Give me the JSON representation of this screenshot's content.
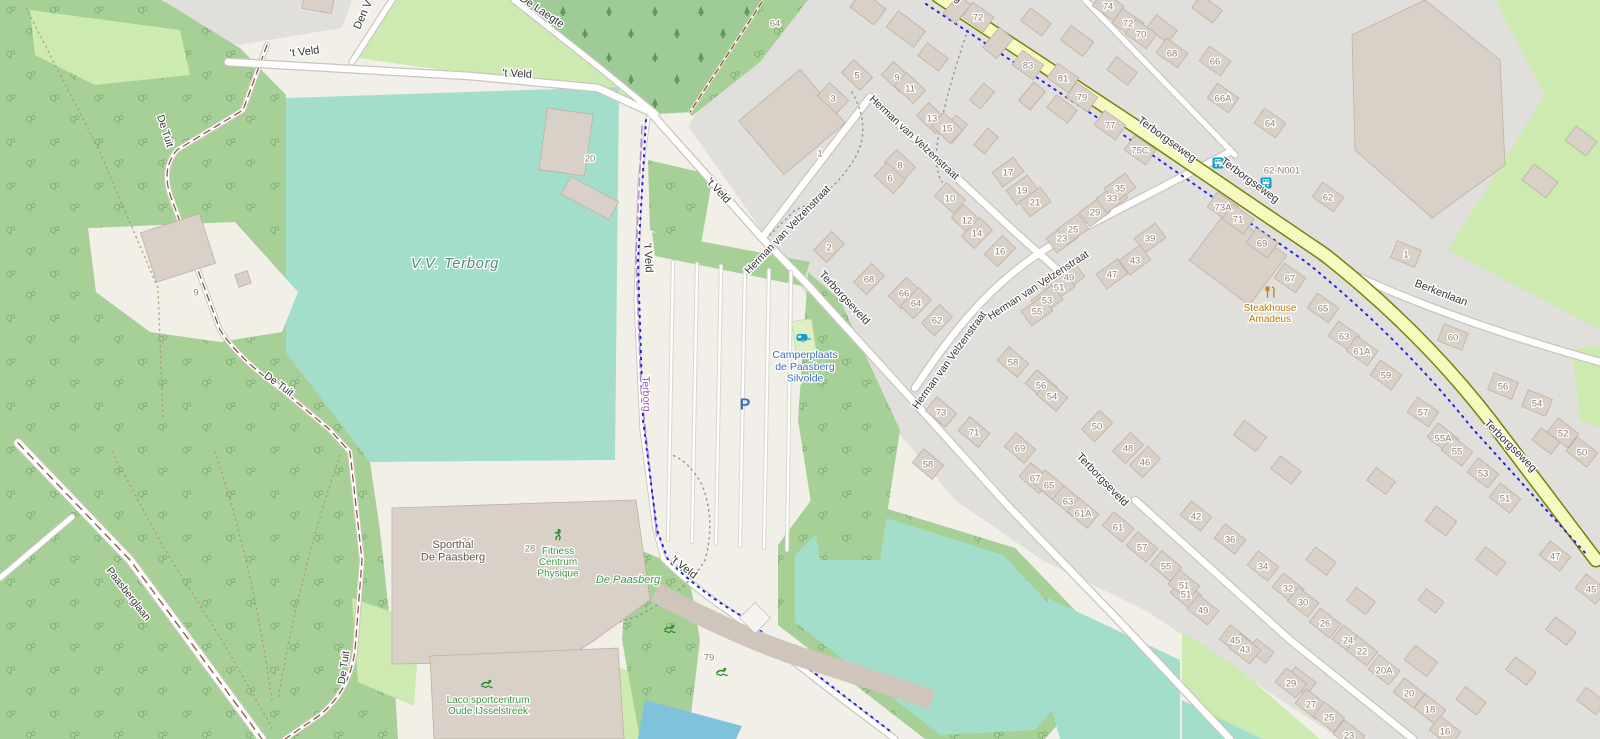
{
  "map": {
    "colors": {
      "background": "#f2efe9",
      "residential": "#e1dfdc",
      "forest": "#a6d096",
      "conifer_forest": "#9fcb97",
      "meadow": "#cdebb0",
      "pitch": "#a3deca",
      "building": "#d9d0c8",
      "building_stroke": "#bfb1a3",
      "road_fill": "#ffffff",
      "road_casing": "#c9c5bf",
      "secondary_road": "#f7fabf",
      "secondary_casing": "#77800a",
      "water": "#7fc3da",
      "cycle_route": "#2222e0",
      "boundary": "#a86fc5",
      "track_dash": "#8a5a3a",
      "street_label": "#353535",
      "house_number": "#8d8072",
      "leisure_label": "#3e9446",
      "tourism_label": "#3f6eb5",
      "amenity_label": "#bd7a00",
      "pitch_label": "#54897b",
      "poi_teal": "#0f9ec7",
      "parking_blue": "#3c6eb4",
      "sport_green": "#2e8b2e"
    },
    "street_labels": [
      {
        "t": "'t Veld",
        "x": 305,
        "y": 55,
        "r": -7,
        "s": 11
      },
      {
        "t": "'t Veld",
        "x": 517,
        "y": 77,
        "r": 3,
        "s": 11
      },
      {
        "t": "De Laegte",
        "x": 540,
        "y": 14,
        "r": 34,
        "s": 11
      },
      {
        "t": "Den V",
        "x": 366,
        "y": 16,
        "r": -66,
        "s": 11
      },
      {
        "t": "'t Veld",
        "x": 716,
        "y": 193,
        "r": 47,
        "s": 11
      },
      {
        "t": "'t Veld",
        "x": 645,
        "y": 258,
        "r": 87,
        "s": 11
      },
      {
        "t": "'t Veld",
        "x": 682,
        "y": 570,
        "r": 38,
        "s": 11
      },
      {
        "t": "De Tuit",
        "x": 162,
        "y": 132,
        "r": 72,
        "s": 10.5
      },
      {
        "t": "De Tuit",
        "x": 277,
        "y": 387,
        "r": 36,
        "s": 10.5
      },
      {
        "t": "De Tuit",
        "x": 347,
        "y": 668,
        "r": -82,
        "s": 10.5
      },
      {
        "t": "Paasberglaan",
        "x": 126,
        "y": 596,
        "r": 52,
        "s": 10.5
      },
      {
        "t": "Terborgseveld",
        "x": 842,
        "y": 300,
        "r": 47,
        "s": 11
      },
      {
        "t": "Terborgseveld",
        "x": 1100,
        "y": 482,
        "r": 46,
        "s": 11
      },
      {
        "t": "Herman van Velzenstraat",
        "x": 790,
        "y": 232,
        "r": -46,
        "s": 10.5
      },
      {
        "t": "Herman van Velzenstraat",
        "x": 912,
        "y": 140,
        "r": 43,
        "s": 10.5
      },
      {
        "t": "Herman van Velzenstraat",
        "x": 1040,
        "y": 288,
        "r": -33,
        "s": 10.5
      },
      {
        "t": "Herman van Velzenstraat",
        "x": 952,
        "y": 362,
        "r": -54,
        "s": 10.5
      },
      {
        "t": "Terborgseweg",
        "x": 930,
        "y": -16,
        "r": 33,
        "s": 11
      },
      {
        "t": "Terborgseweg",
        "x": 1165,
        "y": 142,
        "r": 36,
        "s": 11
      },
      {
        "t": "Terborgseweg",
        "x": 1248,
        "y": 183,
        "r": 36,
        "s": 11
      },
      {
        "t": "Terborgseweg",
        "x": 1508,
        "y": 448,
        "r": 45,
        "s": 11
      },
      {
        "t": "Berkenlaan",
        "x": 1440,
        "y": 296,
        "r": 21,
        "s": 11
      }
    ],
    "place_labels": [
      {
        "lines": [
          "V.V. Terborg"
        ],
        "x": 455,
        "y": 268,
        "c": "#54897b",
        "s": 14.5,
        "i": 1,
        "ls": 0.8
      },
      {
        "lines": [
          "De Paasberg"
        ],
        "x": 628,
        "y": 583,
        "c": "#3e9446",
        "s": 11,
        "i": 1
      },
      {
        "lines": [
          "Terborg"
        ],
        "x": 643,
        "y": 394,
        "c": "#9a56b0",
        "s": 10.5,
        "r": 88
      },
      {
        "lines": [
          "Camperplaats",
          "de Paasberg",
          "Silvolde"
        ],
        "x": 805,
        "y": 358,
        "c": "#3f6eb5",
        "s": 10.5
      },
      {
        "lines": [
          "Steakhouse",
          "Amadeus"
        ],
        "x": 1270,
        "y": 311,
        "c": "#bd7a00",
        "s": 10
      },
      {
        "lines": [
          "Sporthal",
          "De Paasberg"
        ],
        "x": 453,
        "y": 548,
        "c": "#5f564c",
        "s": 11
      },
      {
        "lines": [
          "Fitness",
          "Centrum",
          "Physique"
        ],
        "x": 558,
        "y": 554,
        "c": "#3e9446",
        "s": 10
      },
      {
        "lines": [
          "Laco sportcentrum",
          "Oude IJsselstreek"
        ],
        "x": 488,
        "y": 703,
        "c": "#3e9446",
        "s": 10
      }
    ],
    "house_numbers": [
      [
        "64",
        775,
        23,
        "x"
      ],
      [
        "74",
        1108,
        6,
        35
      ],
      [
        "72",
        978,
        17,
        35
      ],
      [
        "72",
        1128,
        23,
        35
      ],
      [
        "70",
        1141,
        34,
        35
      ],
      [
        "68",
        1172,
        53,
        35
      ],
      [
        "66",
        1215,
        61,
        35
      ],
      [
        "66A",
        1223,
        98,
        35
      ],
      [
        "64",
        1270,
        123,
        35
      ],
      [
        "62-N001",
        1282,
        170,
        "x"
      ],
      [
        "62",
        1328,
        197,
        35
      ],
      [
        "73A",
        1223,
        207,
        35
      ],
      [
        "71",
        1238,
        219,
        35
      ],
      [
        "83",
        1028,
        65,
        35
      ],
      [
        "81",
        1063,
        78,
        35
      ],
      [
        "79",
        1082,
        97,
        35
      ],
      [
        "77",
        1110,
        125,
        35
      ],
      [
        "75C",
        1140,
        150,
        35
      ],
      [
        "5",
        857,
        75,
        43
      ],
      [
        "3",
        833,
        98,
        43
      ],
      [
        "9",
        897,
        77,
        43
      ],
      [
        "11",
        910,
        88,
        43
      ],
      [
        "13",
        932,
        118,
        43
      ],
      [
        "15",
        947,
        128,
        43
      ],
      [
        "1",
        820,
        153,
        "x"
      ],
      [
        "8",
        900,
        165,
        43
      ],
      [
        "6",
        890,
        178,
        43
      ],
      [
        "10",
        950,
        198,
        43
      ],
      [
        "12",
        967,
        220,
        43
      ],
      [
        "14",
        977,
        233,
        -46
      ],
      [
        "16",
        1000,
        251,
        -46
      ],
      [
        "17",
        1008,
        172,
        -36
      ],
      [
        "19",
        1022,
        190,
        -36
      ],
      [
        "21",
        1035,
        202,
        -36
      ],
      [
        "23",
        1062,
        238,
        -36
      ],
      [
        "25",
        1073,
        229,
        -36
      ],
      [
        "29",
        1095,
        212,
        -36
      ],
      [
        "33",
        1112,
        198,
        -36
      ],
      [
        "35",
        1120,
        188,
        -36
      ],
      [
        "39",
        1150,
        238,
        -36
      ],
      [
        "43",
        1135,
        260,
        -36
      ],
      [
        "47",
        1112,
        274,
        -36
      ],
      [
        "49",
        1069,
        277,
        -36
      ],
      [
        "51",
        1059,
        287,
        -36
      ],
      [
        "53",
        1047,
        300,
        -36
      ],
      [
        "55",
        1037,
        311,
        -36
      ],
      [
        "2",
        829,
        247,
        -46
      ],
      [
        "68",
        869,
        279,
        -46
      ],
      [
        "66",
        904,
        293,
        -46
      ],
      [
        "64",
        916,
        303,
        -46
      ],
      [
        "62",
        937,
        320,
        -46
      ],
      [
        "58",
        1013,
        362,
        40
      ],
      [
        "56",
        1041,
        385,
        40
      ],
      [
        "54",
        1052,
        396,
        40
      ],
      [
        "50",
        1097,
        426,
        -46
      ],
      [
        "48",
        1128,
        448,
        -46
      ],
      [
        "46",
        1145,
        462,
        -46
      ],
      [
        "73",
        941,
        412,
        40
      ],
      [
        "71",
        974,
        432,
        40
      ],
      [
        "69",
        1020,
        448,
        40
      ],
      [
        "67",
        1035,
        478,
        40
      ],
      [
        "65",
        1049,
        485,
        40
      ],
      [
        "63",
        1068,
        501,
        40
      ],
      [
        "61A",
        1083,
        513,
        40
      ],
      [
        "61",
        1118,
        527,
        40
      ],
      [
        "58",
        928,
        464,
        40
      ],
      [
        "57",
        1142,
        547,
        40
      ],
      [
        "55",
        1166,
        566,
        40
      ],
      [
        "51",
        1186,
        594,
        40
      ],
      [
        "42",
        1196,
        516,
        38
      ],
      [
        "36",
        1230,
        539,
        38
      ],
      [
        "34",
        1263,
        566,
        38
      ],
      [
        "32",
        1288,
        588,
        38
      ],
      [
        "30",
        1303,
        602,
        38
      ],
      [
        "26",
        1325,
        623,
        38
      ],
      [
        "24",
        1348,
        640,
        38
      ],
      [
        "22",
        1362,
        651,
        38
      ],
      [
        "20A",
        1384,
        670,
        38
      ],
      [
        "20",
        1409,
        693,
        38
      ],
      [
        "18",
        1430,
        709,
        38
      ],
      [
        "16",
        1445,
        731,
        38
      ],
      [
        "51",
        1184,
        585,
        38
      ],
      [
        "49",
        1203,
        610,
        38
      ],
      [
        "45",
        1235,
        640,
        38
      ],
      [
        "43",
        1245,
        649,
        38
      ],
      [
        "29",
        1291,
        683,
        38
      ],
      [
        "27",
        1311,
        704,
        38
      ],
      [
        "25",
        1329,
        717,
        38
      ],
      [
        "23",
        1349,
        735,
        38
      ],
      [
        "52",
        1563,
        433,
        38
      ],
      [
        "50",
        1582,
        452,
        38
      ],
      [
        "55A",
        1443,
        438,
        38
      ],
      [
        "55",
        1457,
        451,
        38
      ],
      [
        "53",
        1483,
        473,
        38
      ],
      [
        "51",
        1505,
        498,
        38
      ],
      [
        "47",
        1555,
        556,
        38
      ],
      [
        "45",
        1591,
        589,
        38
      ],
      [
        "69",
        1262,
        243,
        35
      ],
      [
        "67",
        1290,
        278,
        35
      ],
      [
        "65",
        1323,
        308,
        35
      ],
      [
        "63",
        1344,
        336,
        35
      ],
      [
        "61A",
        1362,
        351,
        35
      ],
      [
        "59",
        1386,
        375,
        35
      ],
      [
        "57",
        1423,
        412,
        35
      ],
      [
        "60",
        1453,
        337,
        22
      ],
      [
        "56",
        1503,
        386,
        22
      ],
      [
        "54",
        1537,
        403,
        22
      ],
      [
        "1",
        1406,
        254,
        22
      ],
      [
        "20",
        590,
        158,
        "x"
      ],
      [
        "9",
        196,
        292,
        "x"
      ],
      [
        "30",
        467,
        541,
        "x"
      ],
      [
        "28",
        530,
        548,
        "x"
      ],
      [
        "79",
        709,
        657,
        "x"
      ]
    ],
    "icons": [
      {
        "k": "parking",
        "x": 745,
        "y": 404
      },
      {
        "k": "caravan",
        "x": 803,
        "y": 338
      },
      {
        "k": "bus",
        "x": 1218,
        "y": 163
      },
      {
        "k": "bus",
        "x": 1266,
        "y": 183
      },
      {
        "k": "restaurant",
        "x": 1270,
        "y": 292
      },
      {
        "k": "swim",
        "x": 487,
        "y": 684
      },
      {
        "k": "swim",
        "x": 670,
        "y": 629
      },
      {
        "k": "swim",
        "x": 722,
        "y": 672
      },
      {
        "k": "run",
        "x": 558,
        "y": 535
      }
    ],
    "buildings": [
      [
        868,
        8,
        30,
        20,
        37
      ],
      [
        906,
        29,
        34,
        20,
        37
      ],
      [
        933,
        57,
        26,
        16,
        37
      ],
      [
        957,
        9,
        24,
        16,
        -50
      ],
      [
        998,
        43,
        26,
        18,
        -50
      ],
      [
        1036,
        22,
        26,
        16,
        37
      ],
      [
        1077,
        41,
        28,
        18,
        37
      ],
      [
        1032,
        96,
        24,
        15,
        -50
      ],
      [
        982,
        96,
        22,
        14,
        -50
      ],
      [
        954,
        129,
        24,
        15,
        -50
      ],
      [
        986,
        141,
        22,
        14,
        -50
      ],
      [
        1062,
        109,
        26,
        16,
        37
      ],
      [
        1122,
        71,
        26,
        16,
        37
      ],
      [
        1162,
        29,
        26,
        16,
        37
      ],
      [
        1207,
        9,
        26,
        16,
        37
      ],
      [
        792,
        122,
        80,
        70,
        -40
      ],
      [
        566,
        142,
        46,
        62,
        8
      ],
      [
        590,
        198,
        54,
        20,
        28
      ],
      [
        318,
        3,
        30,
        16,
        10
      ],
      [
        178,
        248,
        62,
        52,
        -18
      ],
      [
        243,
        279,
        13,
        13,
        -18
      ],
      [
        1238,
        258,
        75,
        62,
        37
      ],
      [
        1250,
        436,
        28,
        18,
        37
      ],
      [
        1286,
        470,
        26,
        16,
        37
      ],
      [
        1321,
        561,
        26,
        16,
        37
      ],
      [
        1361,
        601,
        24,
        16,
        37
      ],
      [
        1421,
        661,
        28,
        18,
        37
      ],
      [
        1471,
        701,
        26,
        16,
        37
      ],
      [
        1521,
        671,
        26,
        16,
        37
      ],
      [
        1561,
        631,
        26,
        16,
        37
      ],
      [
        1591,
        701,
        24,
        16,
        37
      ],
      [
        1381,
        481,
        24,
        16,
        37
      ],
      [
        1441,
        521,
        26,
        18,
        37
      ],
      [
        1491,
        561,
        26,
        16,
        37
      ],
      [
        1301,
        681,
        26,
        16,
        37
      ],
      [
        1261,
        651,
        22,
        14,
        37
      ],
      [
        1431,
        601,
        22,
        14,
        37
      ],
      [
        1546,
        441,
        24,
        15,
        37
      ],
      [
        1540,
        181,
        30,
        20,
        37
      ],
      [
        1581,
        141,
        26,
        18,
        37
      ]
    ]
  }
}
